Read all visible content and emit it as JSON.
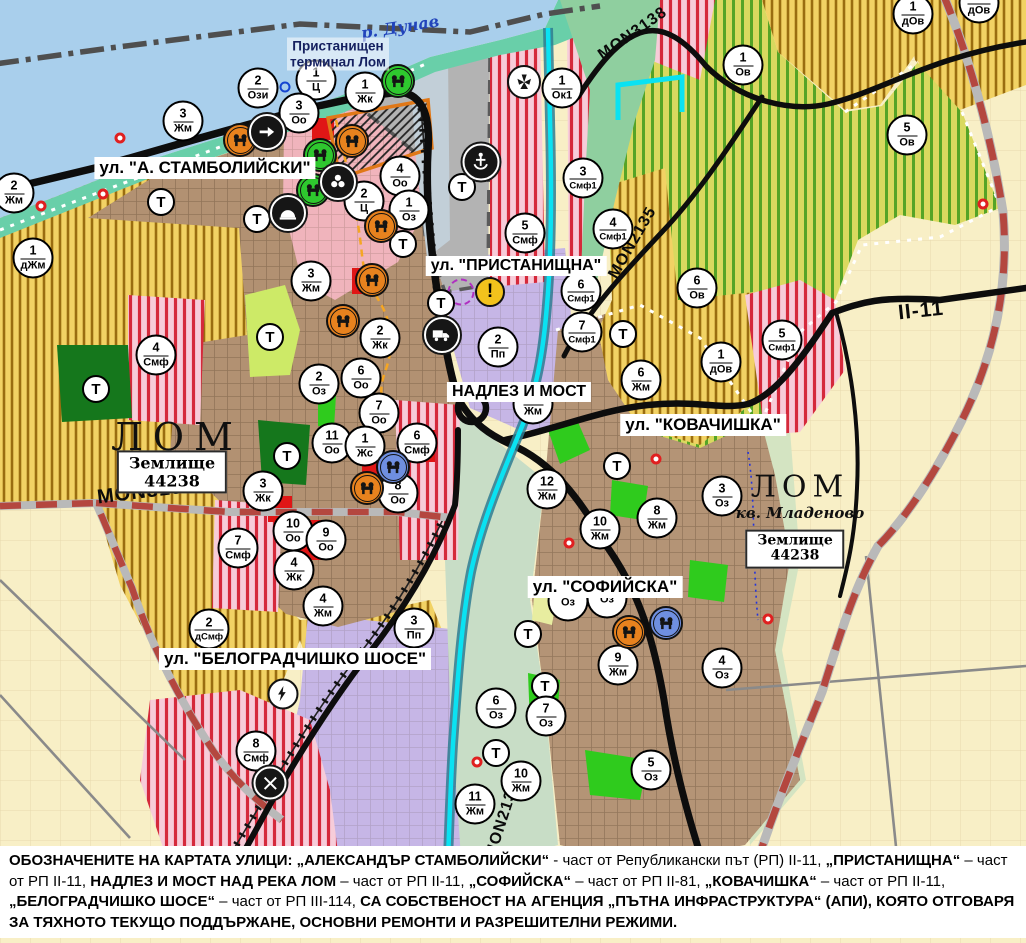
{
  "map": {
    "river_label": "р. Дунав",
    "terminal_label": [
      "Пристанищен",
      "терминал Лом"
    ],
    "city_labels": [
      {
        "name": "ЛОМ",
        "x": 177,
        "y": 437,
        "size": 38,
        "spacing": 10
      },
      {
        "name": "ЛОМ",
        "x": 800,
        "y": 487,
        "size": 30,
        "spacing": 6,
        "sub": "кв. Младеново",
        "sub_x": 800,
        "sub_y": 513,
        "sub_size": 15
      }
    ],
    "land_registry_boxes": [
      {
        "line1": "Землище",
        "line2": "44238",
        "x": 172,
        "y": 472,
        "size": 16
      },
      {
        "line1": "Землище",
        "line2": "44238",
        "x": 795,
        "y": 549,
        "size": 14
      }
    ],
    "street_labels": [
      {
        "text": "ул. \"А. СТАМБОЛИЙСКИ\"",
        "x": 205,
        "y": 168,
        "size": 17
      },
      {
        "text": "ул. \"ПРИСТАНИЩНА\"",
        "x": 516,
        "y": 266,
        "size": 16
      },
      {
        "text": "НАДЛЕЗ И МОСТ",
        "x": 519,
        "y": 392,
        "size": 16
      },
      {
        "text": "ул. \"КОВАЧИШКА\"",
        "x": 703,
        "y": 425,
        "size": 17
      },
      {
        "text": "ул. \"СОФИЙСКА\"",
        "x": 605,
        "y": 587,
        "size": 17
      },
      {
        "text": "ул. \"БЕЛОГРАДЧИШКО ШОСЕ\"",
        "x": 295,
        "y": 659,
        "size": 17
      }
    ],
    "road_labels": [
      {
        "text": "MON3139",
        "x": 146,
        "y": 492,
        "rot": -7,
        "size": 20
      },
      {
        "text": "MON3138",
        "x": 633,
        "y": 34,
        "rot": -35,
        "size": 16
      },
      {
        "text": "MON2135",
        "x": 633,
        "y": 243,
        "rot": -60,
        "size": 16
      },
      {
        "text": "MON2136",
        "x": 503,
        "y": 820,
        "rot": -72,
        "size": 16
      },
      {
        "text": "II-11",
        "x": 921,
        "y": 311,
        "rot": -6,
        "size": 21
      }
    ],
    "zone_markers": [
      {
        "n": "2",
        "c": "Ози",
        "x": 258,
        "y": 88
      },
      {
        "n": "1",
        "c": "Ц",
        "x": 316,
        "y": 80
      },
      {
        "n": "3",
        "c": "Оо",
        "x": 299,
        "y": 113
      },
      {
        "n": "3",
        "c": "Жм",
        "x": 183,
        "y": 121
      },
      {
        "n": "2",
        "c": "Жм",
        "x": 14,
        "y": 193
      },
      {
        "n": "1",
        "c": "Жк",
        "x": 365,
        "y": 92
      },
      {
        "n": "1",
        "c": "Ок1",
        "x": 562,
        "y": 88
      },
      {
        "n": "4",
        "c": "Оо",
        "x": 400,
        "y": 176
      },
      {
        "n": "2",
        "c": "Ц",
        "x": 364,
        "y": 201
      },
      {
        "n": "1",
        "c": "Оз",
        "x": 409,
        "y": 210
      },
      {
        "n": "5",
        "c": "Смф",
        "x": 525,
        "y": 233
      },
      {
        "n": "3",
        "c": "Смф1",
        "x": 583,
        "y": 178
      },
      {
        "n": "4",
        "c": "Смф1",
        "x": 613,
        "y": 229
      },
      {
        "n": "1",
        "c": "дЖм",
        "x": 33,
        "y": 258
      },
      {
        "n": "4",
        "c": "Смф",
        "x": 156,
        "y": 355
      },
      {
        "n": "3",
        "c": "Жм",
        "x": 311,
        "y": 281
      },
      {
        "n": "2",
        "c": "Жк",
        "x": 380,
        "y": 338
      },
      {
        "n": "2",
        "c": "Оз",
        "x": 319,
        "y": 384
      },
      {
        "n": "6",
        "c": "Оо",
        "x": 361,
        "y": 378
      },
      {
        "n": "7",
        "c": "Оо",
        "x": 379,
        "y": 413
      },
      {
        "n": "11",
        "c": "Оо",
        "x": 332,
        "y": 443
      },
      {
        "n": "1",
        "c": "Жс",
        "x": 365,
        "y": 446
      },
      {
        "n": "6",
        "c": "Смф",
        "x": 417,
        "y": 443
      },
      {
        "n": "8",
        "c": "Оо",
        "x": 398,
        "y": 493
      },
      {
        "n": "3",
        "c": "Жк",
        "x": 263,
        "y": 491
      },
      {
        "n": "2",
        "c": "Пп",
        "x": 498,
        "y": 347
      },
      {
        "n": "5",
        "c": "Жм",
        "x": 533,
        "y": 404
      },
      {
        "n": "12",
        "c": "Жм",
        "x": 547,
        "y": 489
      },
      {
        "n": "6",
        "c": "Смф1",
        "x": 581,
        "y": 291
      },
      {
        "n": "7",
        "c": "Смф1",
        "x": 582,
        "y": 332
      },
      {
        "n": "6",
        "c": "Ов",
        "x": 697,
        "y": 288
      },
      {
        "n": "5",
        "c": "Смф1",
        "x": 782,
        "y": 340
      },
      {
        "n": "1",
        "c": "дОв",
        "x": 721,
        "y": 362
      },
      {
        "n": "6",
        "c": "Жм",
        "x": 641,
        "y": 380
      },
      {
        "n": "1",
        "c": "Ов",
        "x": 743,
        "y": 65
      },
      {
        "n": "5",
        "c": "Ов",
        "x": 907,
        "y": 135
      },
      {
        "n": "1",
        "c": "дОв",
        "x": 913,
        "y": 14
      },
      {
        "n": "1",
        "c": "дОв",
        "x": 979,
        "y": 3
      },
      {
        "n": "3",
        "c": "Оз",
        "x": 722,
        "y": 496
      },
      {
        "n": "8",
        "c": "Жм",
        "x": 657,
        "y": 518
      },
      {
        "n": "10",
        "c": "Жм",
        "x": 600,
        "y": 529
      },
      {
        "n": "10",
        "c": "Оо",
        "x": 293,
        "y": 531
      },
      {
        "n": "9",
        "c": "Оо",
        "x": 326,
        "y": 540
      },
      {
        "n": "4",
        "c": "Жк",
        "x": 294,
        "y": 570
      },
      {
        "n": "7",
        "c": "Смф",
        "x": 238,
        "y": 548
      },
      {
        "n": "4",
        "c": "Жм",
        "x": 323,
        "y": 606
      },
      {
        "n": "2",
        "c": "дСмф",
        "x": 209,
        "y": 629
      },
      {
        "n": "3",
        "c": "Пп",
        "x": 414,
        "y": 628
      },
      {
        "n": "8",
        "c": "Смф",
        "x": 256,
        "y": 751
      },
      {
        "n": "9",
        "c": "Жм",
        "x": 618,
        "y": 665
      },
      {
        "n": "4",
        "c": "Оз",
        "x": 722,
        "y": 668
      },
      {
        "n": "6",
        "c": "Оз",
        "x": 496,
        "y": 708
      },
      {
        "n": "7",
        "c": "Оз",
        "x": 546,
        "y": 716
      },
      {
        "n": "5",
        "c": "Оз",
        "x": 651,
        "y": 770
      },
      {
        "n": "10",
        "c": "Жм",
        "x": 521,
        "y": 781
      },
      {
        "n": "11",
        "c": "Жм",
        "x": 475,
        "y": 804
      },
      {
        "n": "",
        "c": "Оз",
        "x": 568,
        "y": 601
      },
      {
        "n": "",
        "c": "Оз",
        "x": 607,
        "y": 598
      }
    ],
    "t_label": "Т",
    "t_markers": [
      {
        "x": 161,
        "y": 202
      },
      {
        "x": 257,
        "y": 219
      },
      {
        "x": 462,
        "y": 187
      },
      {
        "x": 403,
        "y": 244
      },
      {
        "x": 270,
        "y": 337
      },
      {
        "x": 96,
        "y": 389
      },
      {
        "x": 441,
        "y": 303
      },
      {
        "x": 623,
        "y": 334
      },
      {
        "x": 287,
        "y": 456
      },
      {
        "x": 617,
        "y": 466
      },
      {
        "x": 528,
        "y": 634
      },
      {
        "x": 545,
        "y": 686
      },
      {
        "x": 496,
        "y": 753
      }
    ],
    "icon_markers": [
      {
        "type": "monument",
        "bg": "#e8821e",
        "x": 240,
        "y": 140
      },
      {
        "type": "monument",
        "bg": "#e8821e",
        "x": 352,
        "y": 141
      },
      {
        "type": "monument",
        "bg": "#e8821e",
        "x": 381,
        "y": 226
      },
      {
        "type": "monument",
        "bg": "#e8821e",
        "x": 372,
        "y": 280
      },
      {
        "type": "monument",
        "bg": "#e8821e",
        "x": 343,
        "y": 321
      },
      {
        "type": "monument",
        "bg": "#e8821e",
        "x": 367,
        "y": 488
      },
      {
        "type": "monument",
        "bg": "#e8821e",
        "x": 629,
        "y": 632
      },
      {
        "type": "monument",
        "bg": "#2ec82e",
        "x": 398,
        "y": 81
      },
      {
        "type": "monument",
        "bg": "#2ec82e",
        "x": 320,
        "y": 155
      },
      {
        "type": "monument",
        "bg": "#2ec82e",
        "x": 313,
        "y": 190
      },
      {
        "type": "monument",
        "bg": "#6f8fe0",
        "x": 393,
        "y": 467
      },
      {
        "type": "monument",
        "bg": "#6f8fe0",
        "x": 666,
        "y": 623
      },
      {
        "type": "anchor",
        "bg": "#161616",
        "x": 481,
        "y": 162
      },
      {
        "type": "arrow",
        "bg": "#161616",
        "x": 267,
        "y": 132
      },
      {
        "type": "trefoil",
        "bg": "#161616",
        "x": 338,
        "y": 182
      },
      {
        "type": "arch",
        "bg": "#161616",
        "x": 288,
        "y": 213
      },
      {
        "type": "truck",
        "bg": "#161616",
        "x": 442,
        "y": 335
      },
      {
        "type": "railcross",
        "bg": "#161616",
        "x": 270,
        "y": 783
      },
      {
        "type": "fan",
        "bg": "#ffffff",
        "x": 524,
        "y": 82
      },
      {
        "type": "lightning",
        "bg": "#ffffff",
        "x": 283,
        "y": 694
      },
      {
        "type": "warning",
        "bg": "#f2c21c",
        "x": 490,
        "y": 292
      }
    ],
    "ring_markers": {
      "red": [
        {
          "x": 41,
          "y": 206
        },
        {
          "x": 103,
          "y": 194
        },
        {
          "x": 120,
          "y": 138
        },
        {
          "x": 983,
          "y": 204
        },
        {
          "x": 656,
          "y": 459
        },
        {
          "x": 569,
          "y": 543
        },
        {
          "x": 477,
          "y": 762
        },
        {
          "x": 768,
          "y": 619
        }
      ],
      "blue": [
        {
          "x": 285,
          "y": 87
        }
      ],
      "purple": [
        {
          "x": 461,
          "y": 292
        }
      ]
    },
    "colors": {
      "water": "#a9cfec",
      "shore": "#69cfa9",
      "port_gray": "#b3b3b3",
      "urban_brown": "#b29172",
      "pink_center": "#f0b4bc",
      "zone_yellow": "#f2d264",
      "zone_yellow_stripe": "#9a6d10",
      "zone_green": "#d9d95f",
      "zone_green_stripe": "#55a426",
      "zone_red_bg": "#f7ccd9",
      "zone_red_stripe": "#d5293b",
      "zone_purple": "#c6b6e6",
      "fields": "#f8efc6",
      "park_dark_green": "#15771c",
      "bright_green": "#2fcb1d",
      "red_patch": "#e01616",
      "cyan_channel": "#0ae2f2",
      "road_black": "#0d0d0d",
      "road_dashed": "#b4473f"
    }
  },
  "caption": {
    "segments": [
      {
        "b": true,
        "t": "ОБОЗНАЧЕНИТЕ НА КАРТАТА УЛИЦИ: „АЛЕКСАНДЪР СТАМБОЛИЙСКИ“"
      },
      {
        "b": false,
        "t": " - част от Републикански път (РП) II-11, "
      },
      {
        "b": true,
        "t": "„ПРИСТАНИЩНА“"
      },
      {
        "b": false,
        "t": " – част от РП II-11, "
      },
      {
        "b": true,
        "t": "НАДЛЕЗ И МОСТ НАД РЕКА ЛОМ"
      },
      {
        "b": false,
        "t": " – част от РП II-11, "
      },
      {
        "b": true,
        "t": "„СОФИЙСКА“"
      },
      {
        "b": false,
        "t": " – част от РП II-81, "
      },
      {
        "b": true,
        "t": "„КОВАЧИШКА“"
      },
      {
        "b": false,
        "t": " – част от РП II-11, "
      },
      {
        "b": true,
        "t": "„БЕЛОГРАДЧИШКО ШОСЕ“"
      },
      {
        "b": false,
        "t": " – част от РП III-114, "
      },
      {
        "b": true,
        "t": "СА СОБСТВЕНОСТ НА АГЕНЦИЯ „ПЪТНА ИНФРАСТРУКТУРА“ (АПИ), КОЯТО ОТГОВАРЯ ЗА ТЯХНОТО ТЕКУЩО ПОДДЪРЖАНЕ, ОСНОВНИ РЕМОНТИ И РАЗРЕШИТЕЛНИ РЕЖИМИ."
      }
    ]
  }
}
